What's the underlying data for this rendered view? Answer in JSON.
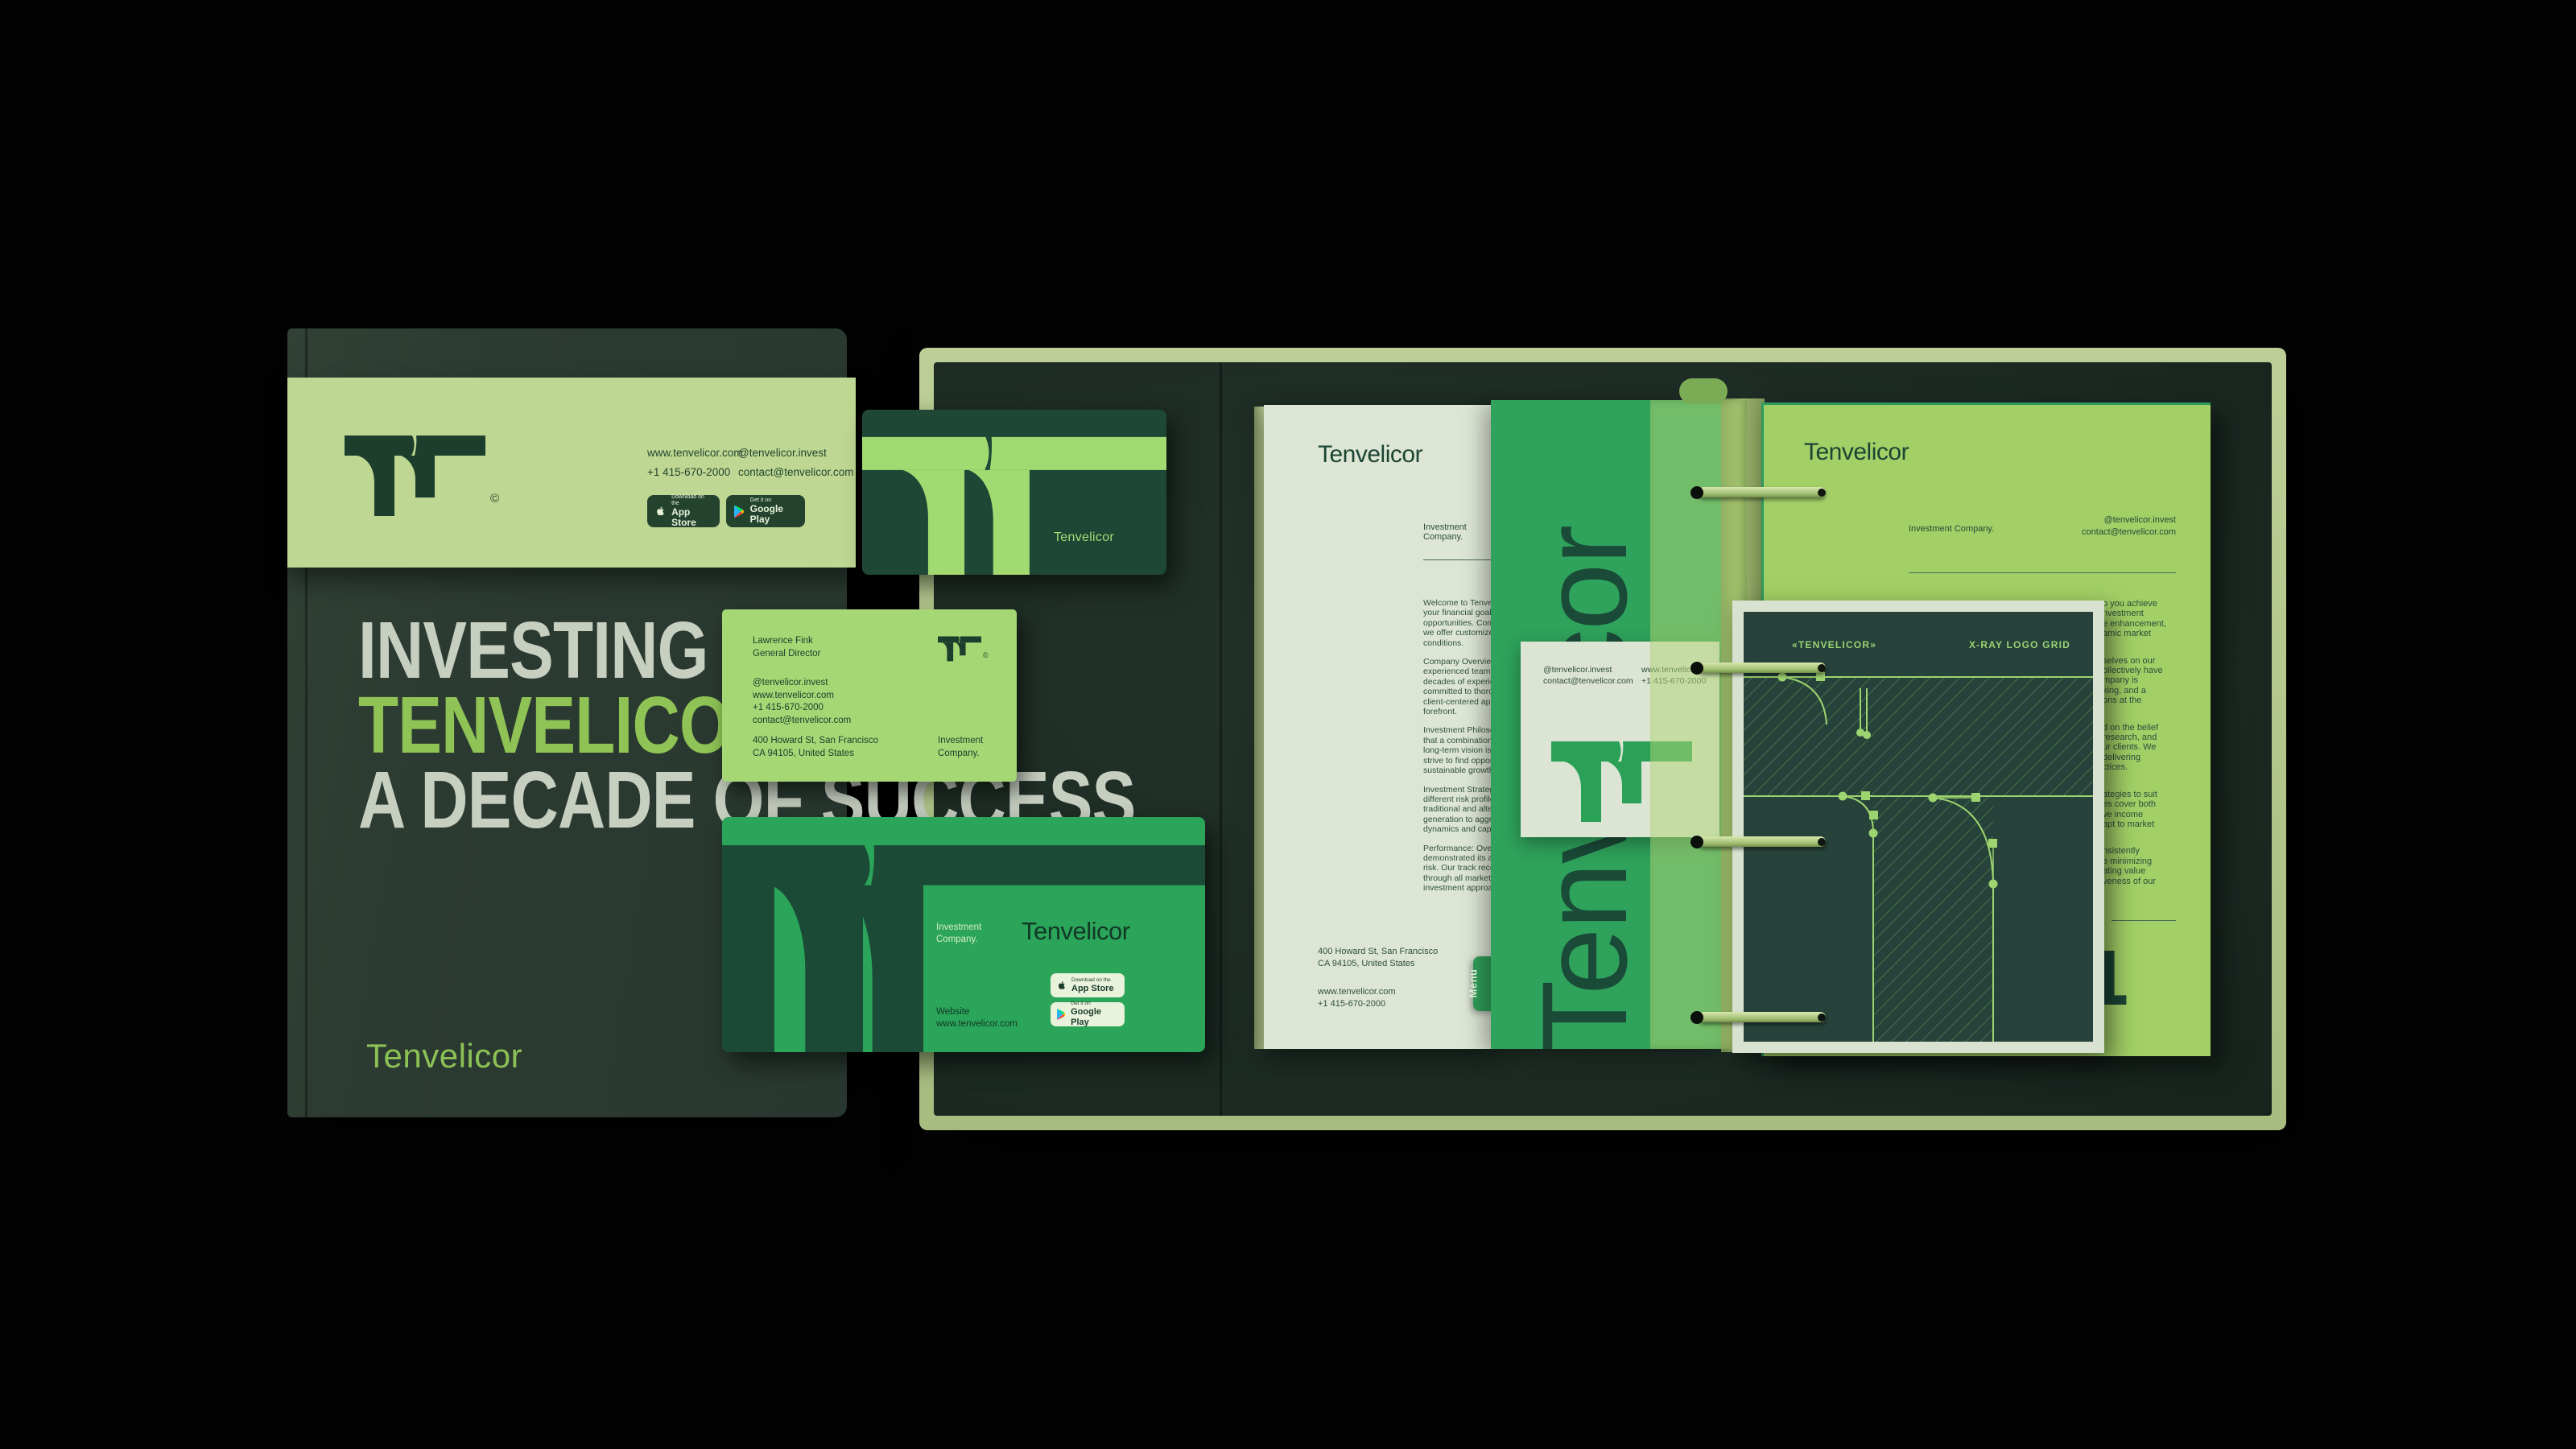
{
  "brand": {
    "name": "Tenvelicor",
    "tagline": "Investment Company.",
    "copyright": "©"
  },
  "contact": {
    "website": "www.tenvelicor.com",
    "phone": "+1 415-670-2000",
    "social": "@tenvelicor.invest",
    "email": "contact@tenvelicor.com",
    "address1": "400 Howard St, San Francisco",
    "address2": "CA 94105, United States"
  },
  "badges": {
    "appstore_pre": "Download on the",
    "appstore_name": "App Store",
    "gplay_pre": "Get it on",
    "gplay_name": "Google Play"
  },
  "book": {
    "title1": "INVESTING WITH",
    "title2": "TENVELICOR",
    "title3": "A DECADE OF SUCCESS",
    "logotype": "Tenvelicor"
  },
  "card": {
    "person": "Lawrence Fink",
    "role": "General Director"
  },
  "envelope": {
    "website_label": "Website"
  },
  "document": {
    "heading": "Tenvelicor",
    "tagline": "Investment Company.",
    "menu": "Menu",
    "paragraphs": [
      [
        "Welcome to Tenvelic",
        "your financial goals",
        "opportunities. Comm",
        "we offer customized",
        "conditions."
      ],
      [
        "Company Overview:",
        "experienced team o",
        "decades of experien",
        "committed to thoro",
        "client-centered app",
        "forefront."
      ],
      [
        "Investment Philosop",
        "that a combination",
        "long-term vision is t",
        "strive to find opport",
        "sustainable growth"
      ],
      [
        "Investment Strategi",
        "different risk profile",
        "traditional and alter",
        "generation to aggre",
        "dynamics and capit"
      ],
      [
        "Performance: Over",
        "demonstrated its ab",
        "risk. Our track recor",
        "through all market",
        "investment approac"
      ]
    ]
  },
  "green_page": {
    "vertical_logo": "Tenvelicor"
  },
  "right_page": {
    "heading": "Tenvelicor",
    "tagline": "Investment Company.",
    "page_number": "01",
    "fragments": [
      [
        "o you achieve",
        "nvestment",
        "e enhancement,",
        "amic market"
      ],
      [
        "selves on our",
        "ollectively have",
        "mpany is",
        "king, and a",
        "ons at the"
      ],
      [
        "d on the belief",
        "research, and",
        "ur clients. We",
        "delivering",
        "ctices."
      ],
      [
        "ategies to suit",
        "es cover both",
        "ve income",
        "apt to market"
      ],
      [
        "nsistently",
        "e minimizing",
        "ating value",
        "veness of our"
      ]
    ]
  },
  "xray": {
    "left_label": "«TENVELICOR»",
    "right_label": "X-RAY LOGO GRID"
  },
  "colors": {
    "banner_green": "#bed792",
    "bright_green": "#a0da70",
    "mid_green": "#2ba55a",
    "dark_green": "#1c3f2d",
    "page_green": "#a2d066",
    "cream": "#dde6d5"
  }
}
